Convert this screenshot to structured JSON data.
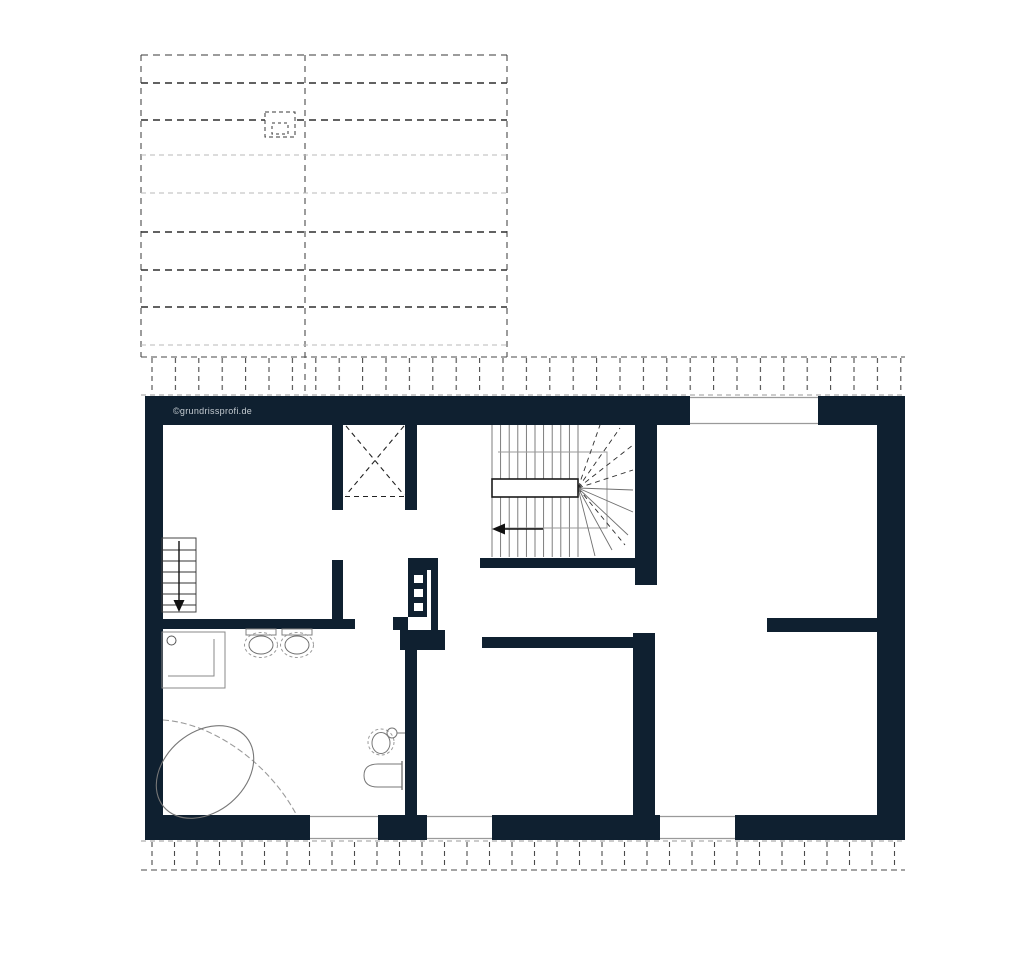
{
  "page": {
    "background": "#ffffff",
    "width": 1024,
    "height": 974
  },
  "watermark": {
    "text": "©grundrissprofi.de",
    "color": "#c4cbd1"
  },
  "colors": {
    "wall_fill": "#0f2030",
    "roof_dash_dark": "#3a3a3a",
    "roof_dash_light": "#b8b8b8",
    "stair_line": "#707070",
    "stair_enclosure": "#9a9a9a",
    "fixture_line": "#808080",
    "window_edge": "#9a9a9a",
    "arrow": "#111111"
  },
  "plan": {
    "type": "floor-plan",
    "floor_features": [
      {
        "id": "roof-plan-overlay",
        "description": "dashed roof outline with ridge, purlin and rafter lines",
        "has_chimney_box": true
      },
      {
        "id": "eaves-band-top",
        "description": "dashed rafter band along top of plan"
      },
      {
        "id": "eaves-band-bottom",
        "description": "dashed rafter band along bottom of plan"
      },
      {
        "id": "chimney-shaft",
        "description": "dashed X-crossed shaft between flanking walls"
      },
      {
        "id": "main-staircase",
        "description": "winder staircase with landing, fanned treads and left direction arrow"
      },
      {
        "id": "secondary-staircase",
        "description": "straight flight with downward arrow"
      },
      {
        "id": "shower",
        "description": "square shower tray with drain circle"
      },
      {
        "id": "washbasins",
        "description": "two oval basins on bathroom wall"
      },
      {
        "id": "corner-bathtub",
        "description": "tilted oval tub inside quarter-circle corner surround"
      },
      {
        "id": "wc",
        "description": "wall-hung WC and small round basin"
      },
      {
        "id": "installation-wall",
        "description": "duct wall with three white openings"
      },
      {
        "id": "windows",
        "count": 4,
        "positions": [
          "top",
          "bottom-left",
          "bottom-center",
          "bottom-right"
        ]
      }
    ]
  }
}
